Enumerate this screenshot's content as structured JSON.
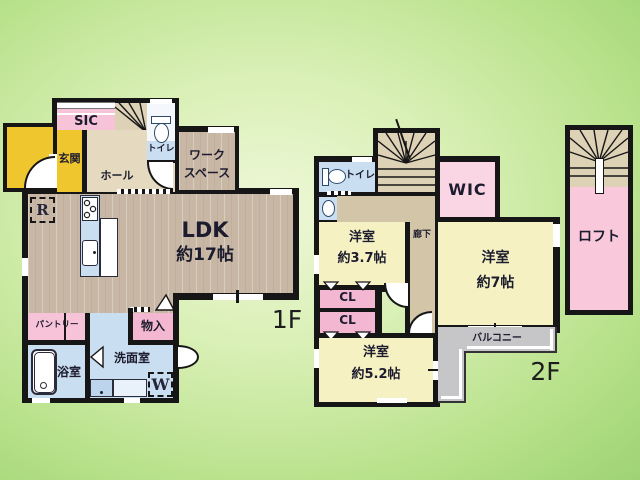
{
  "floor1": {
    "label": "1F",
    "rooms": {
      "sic": "SIC",
      "genkan": "玄関",
      "hall": "ホール",
      "toilet": "トイレ",
      "workspace_line1": "ワーク",
      "workspace_line2": "スペース",
      "ldk_line1": "LDK",
      "ldk_line2": "約17帖",
      "fridge": "R",
      "pantry": "パントリー",
      "storage": "物入",
      "bath": "浴室",
      "washroom": "洗面室",
      "washer": "W"
    }
  },
  "floor2": {
    "label": "2F",
    "rooms": {
      "toilet": "トイレ",
      "wic": "WIC",
      "corridor": "廊下",
      "room37_line1": "洋室",
      "room37_line2": "約3.7帖",
      "closet": "CL",
      "room7_line1": "洋室",
      "room7_line2": "約7帖",
      "room52_line1": "洋室",
      "room52_line2": "約5.2帖",
      "balcony": "バルコニー"
    }
  },
  "loft": {
    "label": "ロフト"
  },
  "colors": {
    "wall": "#161616",
    "wood_floor": "#c9b7a5",
    "hall_beige": "#e5dabf",
    "entrance_yellow": "#f0c62e",
    "closet_pink": "#f7c3d8",
    "bedroom_yellow": "#f6f1c3",
    "wet_area_blue": "#cadef2",
    "balcony_gray": "#c6c6c8",
    "background_green": "#b9e28c",
    "text": "#1c1c2e"
  }
}
